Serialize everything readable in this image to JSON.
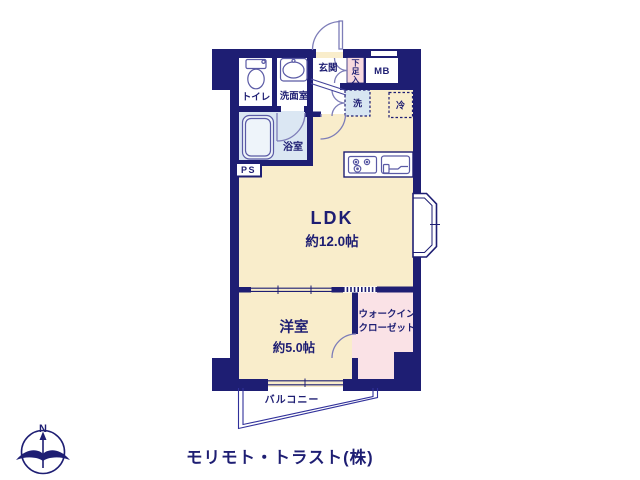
{
  "plan": {
    "rooms": {
      "ldk": {
        "label": "LDK",
        "size": "約12.0帖"
      },
      "bedroom": {
        "label": "洋室",
        "size": "約5.0帖"
      },
      "walk_in_closet": {
        "line1": "ウォークイン",
        "line2": "クローゼット"
      },
      "balcony": {
        "label": "バルコニー"
      },
      "entrance": {
        "label": "玄関"
      },
      "toilet": {
        "label": "トイレ"
      },
      "washroom": {
        "label": "洗面室"
      },
      "bathroom": {
        "label": "浴室"
      },
      "shoe_cabinet": {
        "char1": "下",
        "char2": "足",
        "char3": "入"
      },
      "meter_box": {
        "label": "MB"
      },
      "pipe_space": {
        "label": "PS"
      },
      "washer": {
        "label": "洗"
      },
      "refrigerator": {
        "label": "冷"
      }
    },
    "compass": {
      "label": "N"
    },
    "company": {
      "label": "モリモト・トラスト(株)"
    },
    "colors": {
      "wall_navy": "#1e1e73",
      "floor_cream": "#f9edcb",
      "wet_blue": "#dbe7f3",
      "shoe_pink": "#f7d9de",
      "closet_pink": "#fae2e6",
      "fixture_stroke": "#5a5aa5",
      "door_stroke": "#7d7db8",
      "company_gray": "#c9c9d0"
    }
  }
}
